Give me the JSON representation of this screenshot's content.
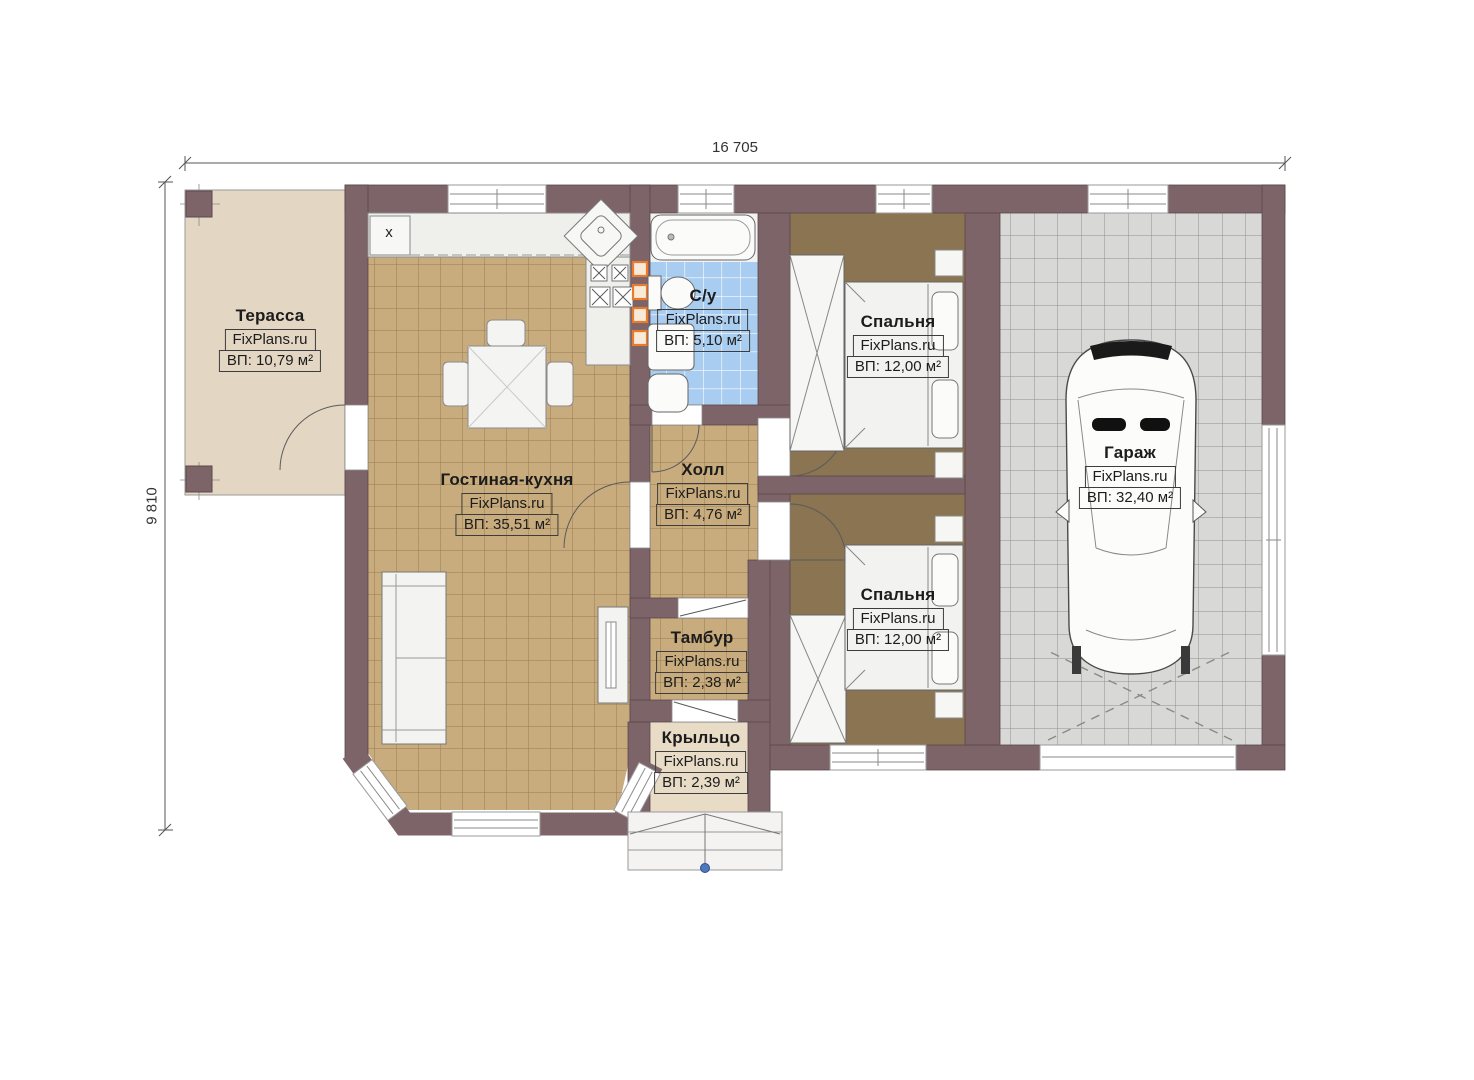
{
  "plan": {
    "brand": "FixPlans.ru",
    "dimensions": {
      "width": "16 705",
      "height": "9 810"
    },
    "kitchen_marker": "х",
    "rooms": {
      "terrace": {
        "name": "Терасса",
        "brand": "FixPlans.ru",
        "area": "ВП: 10,79 м²"
      },
      "living": {
        "name": "Гостиная-кухня",
        "brand": "FixPlans.ru",
        "area": "ВП: 35,51 м²"
      },
      "bathroom": {
        "name": "С/у",
        "brand": "FixPlans.ru",
        "area": "ВП: 5,10 м²"
      },
      "hall": {
        "name": "Холл",
        "brand": "FixPlans.ru",
        "area": "ВП: 4,76 м²"
      },
      "bedroom1": {
        "name": "Спальня",
        "brand": "FixPlans.ru",
        "area": "ВП: 12,00 м²"
      },
      "bedroom2": {
        "name": "Спальня",
        "brand": "FixPlans.ru",
        "area": "ВП: 12,00 м²"
      },
      "garage": {
        "name": "Гараж",
        "brand": "FixPlans.ru",
        "area": "ВП: 32,40 м²"
      },
      "vestibule": {
        "name": "Тамбур",
        "brand": "FixPlans.ru",
        "area": "ВП: 2,38 м²"
      },
      "porch": {
        "name": "Крыльцо",
        "brand": "FixPlans.ru",
        "area": "ВП: 2,39 м²"
      }
    },
    "colors": {
      "wall": "#7c6468",
      "living_floor": "#c9ac7d",
      "bedroom_floor": "#8a7451",
      "bathroom_floor": "#a9cdf0",
      "garage_floor": "#d8d8d6",
      "terrace_floor": "#e3d6c3",
      "porch_floor": "#e8dcc7",
      "accent_orange": "#e87b2e",
      "marker_blue": "#5078be"
    }
  }
}
